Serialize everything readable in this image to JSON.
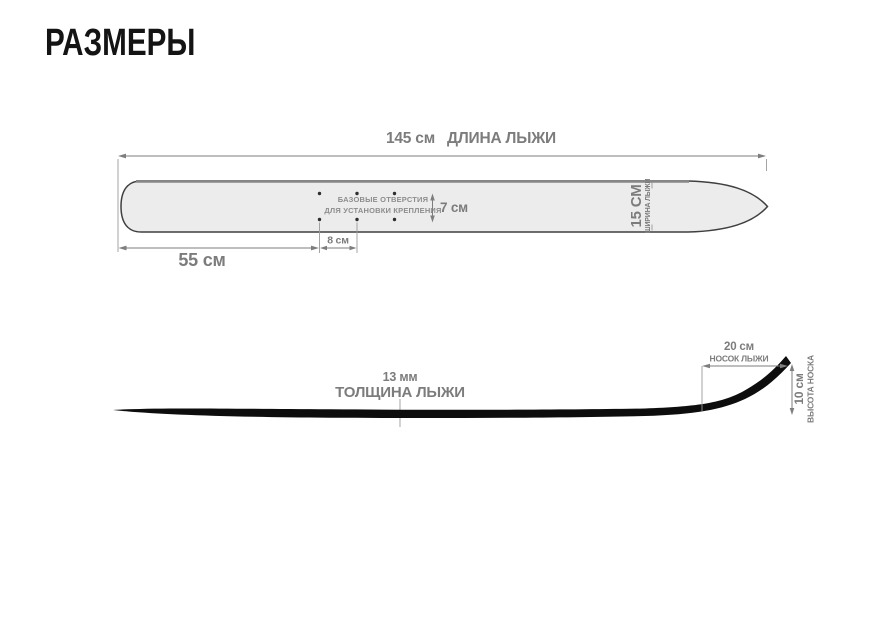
{
  "title": "РАЗМЕРЫ",
  "colors": {
    "background": "#ffffff",
    "title_text": "#141414",
    "ski_fill": "#ececec",
    "ski_outline": "#3f3f3f",
    "ski_top_edge": "#868686",
    "profile_fill": "#0d0d0d",
    "dimension_lines": "#7e7e7e",
    "dimension_text": "#7c7c7c"
  },
  "top_view": {
    "length": {
      "value": "145 см",
      "label": "ДЛИНА ЛЫЖИ"
    },
    "tail_to_holes": "55 см",
    "hole_spacing": "8 см",
    "hole_rows_gap": "7 см",
    "holes_note": [
      "БАЗОВЫЕ ОТВЕРСТИЯ",
      "ДЛЯ УСТАНОВКИ КРЕПЛЕНИЯ"
    ],
    "width": {
      "value": "15 СМ",
      "label": "ШИРИНА ЛЫЖИ"
    }
  },
  "side_view": {
    "thickness": {
      "value": "13 мм",
      "label": "ТОЛЩИНА ЛЫЖИ"
    },
    "tip_length": {
      "value": "20 см",
      "label": "НОСОК ЛЫЖИ"
    },
    "tip_height": {
      "value": "10 см",
      "label": "ВЫСОТА НОСКА"
    }
  }
}
